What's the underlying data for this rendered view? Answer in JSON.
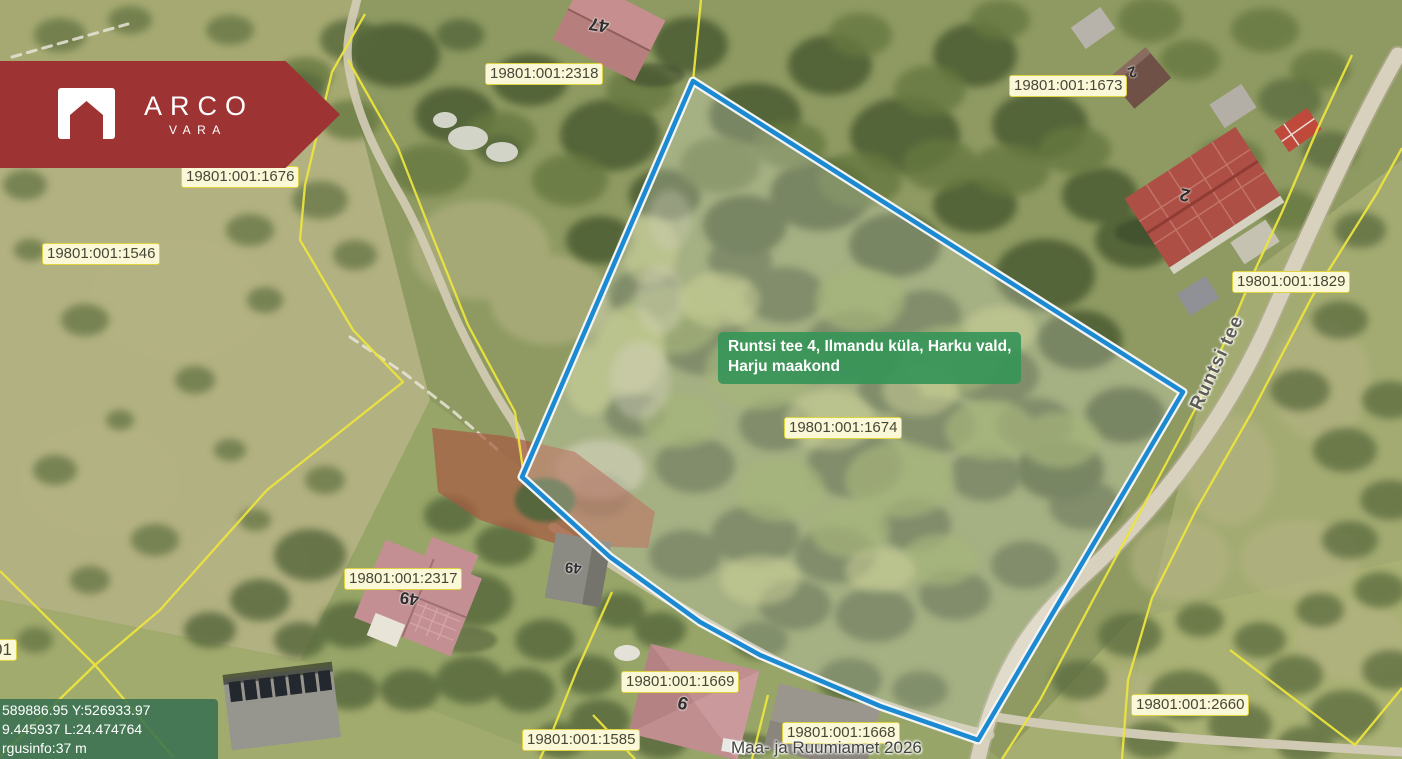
{
  "branding": {
    "logo_primary": "ARCO",
    "logo_secondary": "VARA"
  },
  "map": {
    "selected_parcel": {
      "cadastral_number": "19801:001:1674",
      "outline_color": "#1b8ad2"
    },
    "tooltip": {
      "line1": "Runtsi tee 4, Ilmandu küla, Harku vald,",
      "line2": "Harju maakond"
    },
    "road_label": "Runtsi tee",
    "attribution": "Maa- ja Ruumiamet 2026",
    "coordinates_overlay": {
      "line1": "589886.95 Y:526933.97",
      "line2": "9.445937 L:24.474764",
      "line3": "rgusinfo:37 m"
    },
    "parcel_labels": [
      {
        "id": "2318",
        "text": "19801:001:2318"
      },
      {
        "id": "1676",
        "text": "19801:001:1676"
      },
      {
        "id": "1546",
        "text": "19801:001:1546"
      },
      {
        "id": "1673",
        "text": "19801:001:1673"
      },
      {
        "id": "1829",
        "text": "19801:001:1829"
      },
      {
        "id": "1674",
        "text": "19801:001:1674"
      },
      {
        "id": "2317",
        "text": "19801:001:2317"
      },
      {
        "id": "1669",
        "text": "19801:001:1669"
      },
      {
        "id": "1585",
        "text": "19801:001:1585"
      },
      {
        "id": "1668",
        "text": "19801:001:1668"
      },
      {
        "id": "2660",
        "text": "19801:001:2660"
      },
      {
        "id": "partial-left",
        "text": "01"
      }
    ],
    "house_numbers": [
      "47",
      "2",
      "2",
      "49",
      "49",
      "9"
    ],
    "colors": {
      "banner": "#9d3433",
      "tooltip_bg": "#38945a",
      "badge_bg": "#fbf8d8",
      "badge_border": "#ded23f",
      "cadastral_line": "#ece43e",
      "selection_blue": "#1b8ad2"
    }
  }
}
